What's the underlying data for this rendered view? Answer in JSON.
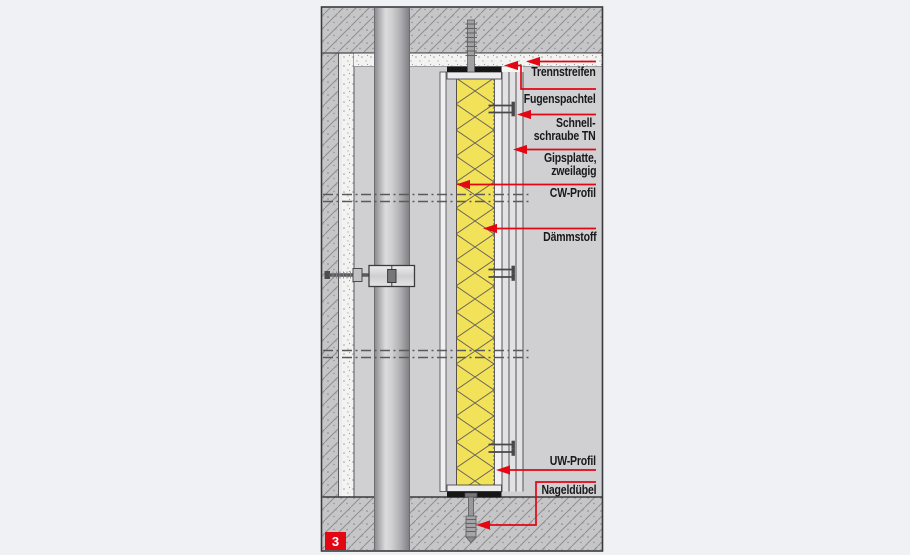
{
  "diagram": {
    "figure_badge": "3",
    "labels": {
      "trennstreifen": "Trennstreifen",
      "fugenspachtel": "Fugenspachtel",
      "schnellschraube_1": "Schnell-",
      "schnellschraube_2": "schraube TN",
      "gipsplatte_1": "Gipsplatte,",
      "gipsplatte_2": "zweilagig",
      "cw_profil": "CW-Profil",
      "daemmstoff": "Dämmstoff",
      "uw_profil": "UW-Profil",
      "nageldubel": "Nageldübel"
    },
    "colors": {
      "accent_red": "#e30613",
      "insulation_yellow": "#f2e25a",
      "page_background": "#f0f1f5",
      "panel_gray": "#d0d0d3",
      "separation_strip_black": "#161616"
    }
  }
}
